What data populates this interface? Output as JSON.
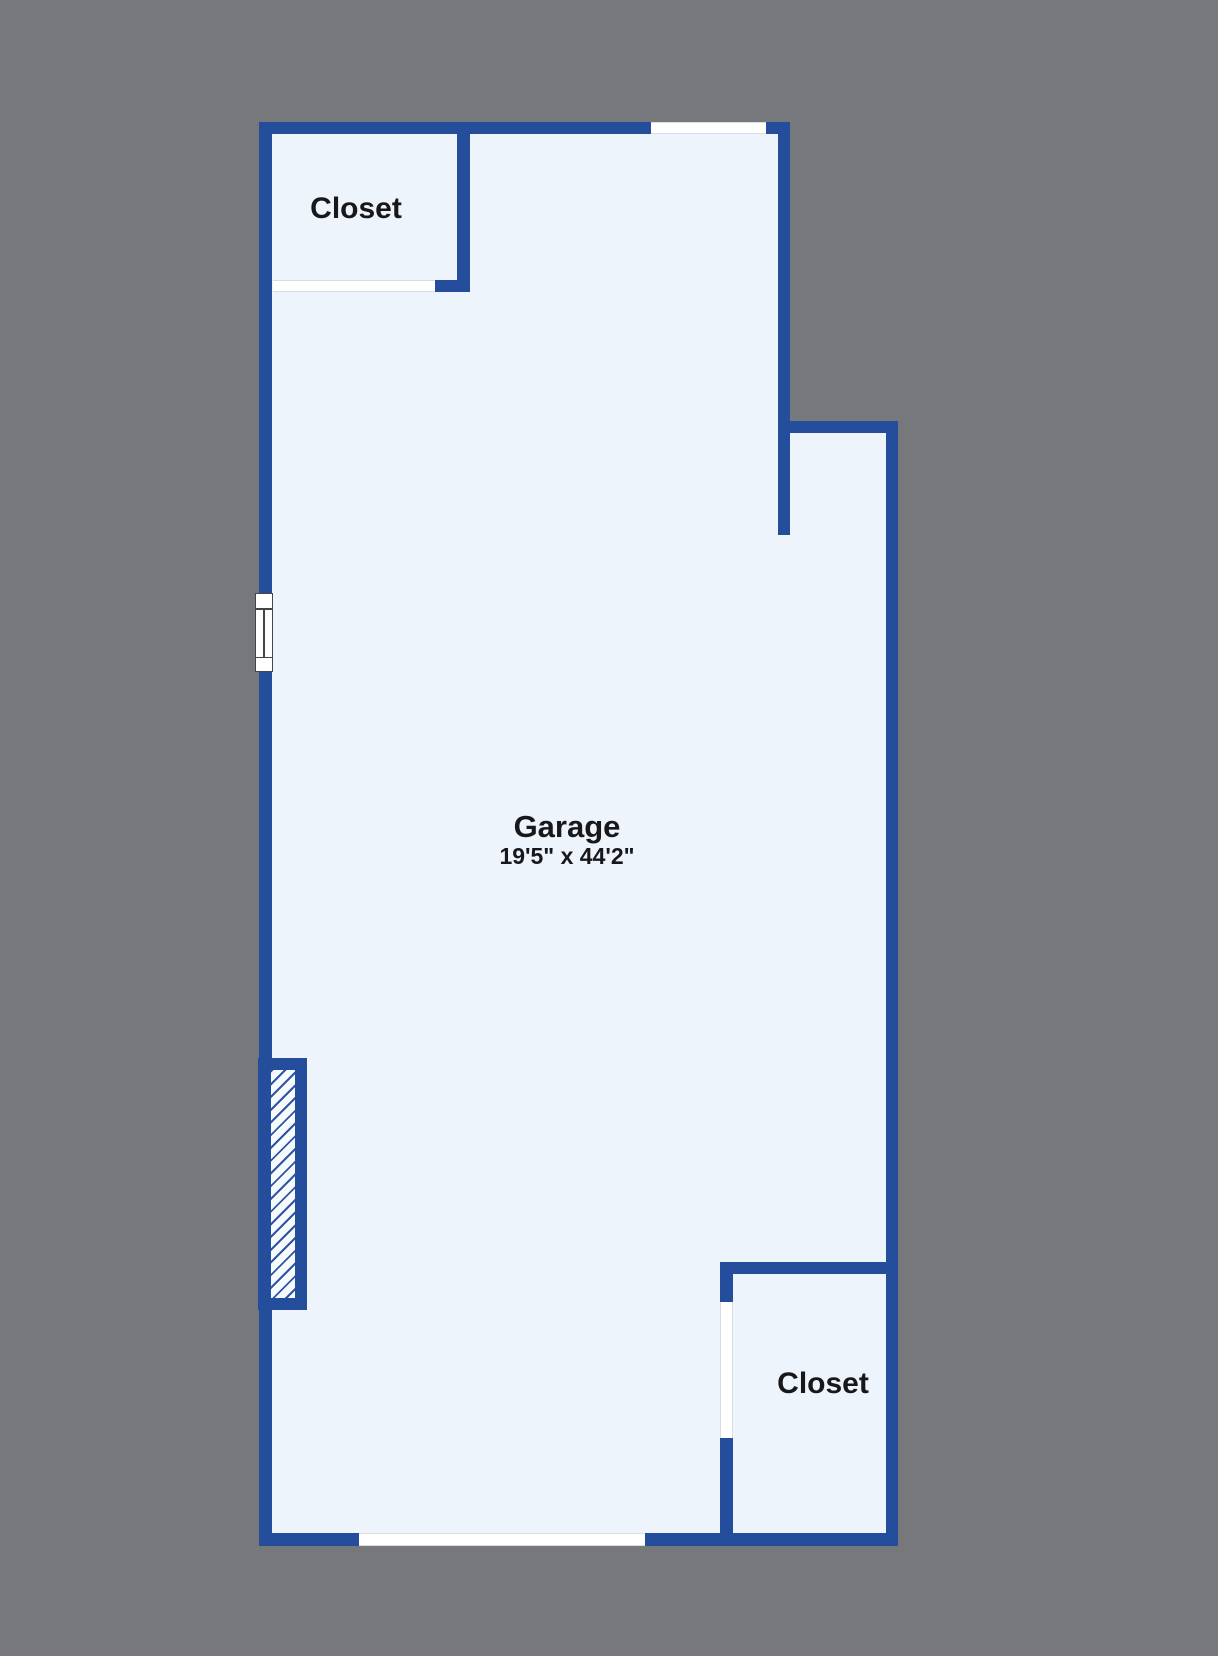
{
  "plan": {
    "colors": {
      "background": "#77787b",
      "wall": "#244d9c",
      "floor": "#edf4fb",
      "text": "#18181b",
      "hatch_line": "#2e56a3"
    },
    "rooms": {
      "closet_top": {
        "label": "Closet"
      },
      "garage": {
        "label": "Garage",
        "dimensions": "19'5\" x 44'2\""
      },
      "closet_bottom": {
        "label": "Closet"
      }
    }
  }
}
